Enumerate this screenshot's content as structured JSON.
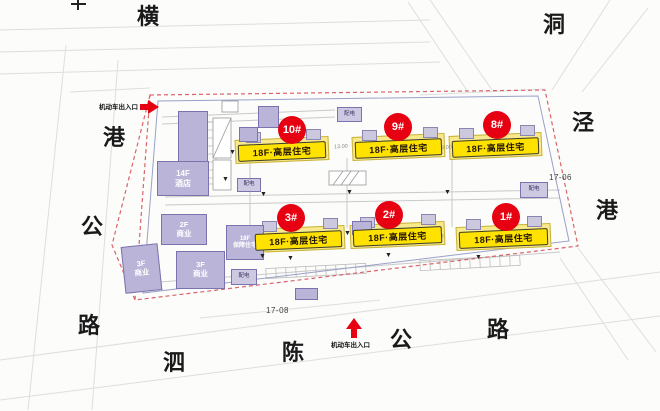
{
  "colors": {
    "marker_red": "#e60012",
    "residential_yellow": "#ffe200",
    "building_lavender": "#b9b4d8",
    "boundary_red": "#d9636a"
  },
  "roads": {
    "west": {
      "name": "横港公路",
      "chars": [
        "横",
        "港",
        "公",
        "路"
      ]
    },
    "east": {
      "name": "洞泾港",
      "chars": [
        "洞",
        "泾",
        "港"
      ]
    },
    "south": {
      "name": "泗陈公路",
      "chars": [
        "泗",
        "陈",
        "公",
        "路"
      ]
    }
  },
  "entrances": {
    "top": {
      "label": "机动车出入口"
    },
    "bottom": {
      "label": "机动车出入口"
    }
  },
  "parcels": {
    "south": "17-08",
    "east": "17-06"
  },
  "residential": [
    {
      "no": "10#",
      "label": "18F·高层住宅"
    },
    {
      "no": "9#",
      "label": "18F·高层住宅"
    },
    {
      "no": "8#",
      "label": "18F·高层住宅"
    },
    {
      "no": "3#",
      "label": "18F·高层住宅"
    },
    {
      "no": "2#",
      "label": "18F·高层住宅"
    },
    {
      "no": "1#",
      "label": "18F·高层住宅"
    }
  ],
  "other_buildings": [
    {
      "label": "14F\n酒店"
    },
    {
      "label": "2F\n商业"
    },
    {
      "label": "3F\n商业"
    },
    {
      "label": "3F\n商业"
    },
    {
      "label": "18F\n保障住宅"
    }
  ],
  "utilities": [
    {
      "label": "配电"
    },
    {
      "label": "配电"
    },
    {
      "label": "配电"
    },
    {
      "label": "配电"
    }
  ],
  "dimensions": [
    {
      "value": "13.00"
    },
    {
      "value": "13.00"
    },
    {
      "value": "23.18"
    }
  ]
}
